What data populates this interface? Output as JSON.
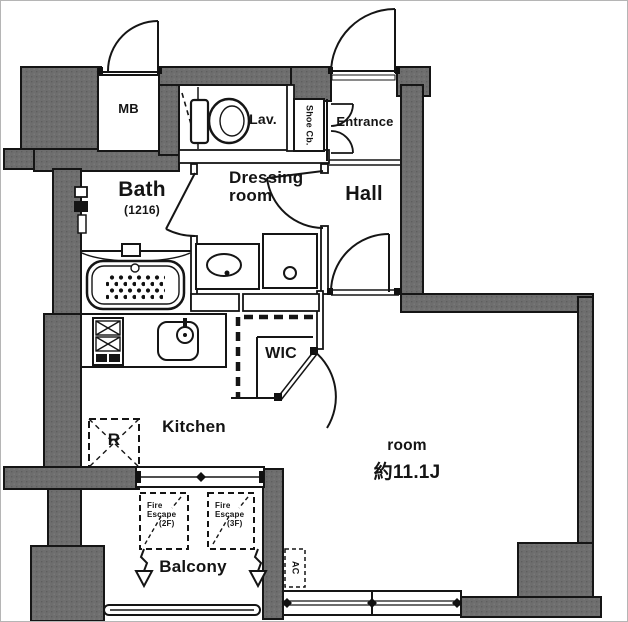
{
  "title": "apartment-floor-plan",
  "colors": {
    "wall": "#6e6e6e",
    "line": "#151515",
    "floor": "#ffffff",
    "text": "#141414"
  },
  "rooms": {
    "mb": {
      "label": "MB"
    },
    "lav": {
      "label": "Lav."
    },
    "shoe_cabinet": {
      "label": "Shoe Cb."
    },
    "entrance": {
      "label": "Entrance"
    },
    "bath": {
      "label": "Bath",
      "size": "(1216)"
    },
    "dressing": {
      "line1": "Dressing",
      "line2": "room"
    },
    "hall": {
      "label": "Hall"
    },
    "wic": {
      "label": "WIC"
    },
    "kitchen": {
      "label": "Kitchen"
    },
    "refrigerator": {
      "label": "R"
    },
    "main_room": {
      "label": "room",
      "size": "約11.1J"
    },
    "balcony": {
      "label": "Balcony"
    },
    "ac": {
      "label": "AC"
    },
    "fire_escape_2f": {
      "line1": "Fire",
      "line2": "Escape",
      "line3": "(2F)"
    },
    "fire_escape_3f": {
      "line1": "Fire",
      "line2": "Escape",
      "line3": "(3F)"
    }
  }
}
